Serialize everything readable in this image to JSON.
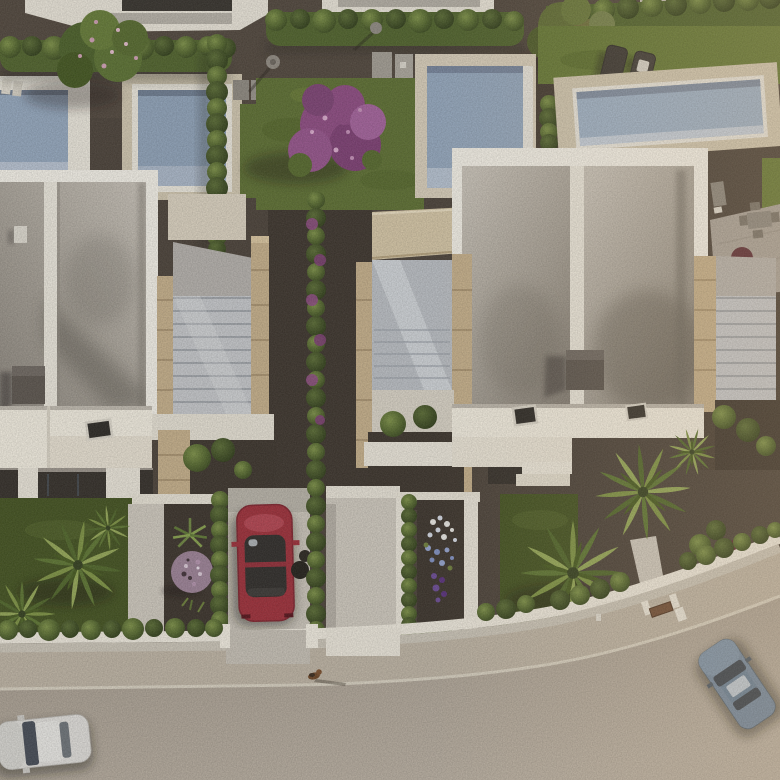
{
  "scene": {
    "type": "aerial-3d-architectural-render",
    "description": "Bird's-eye view of a modern white-villa residential development at golden hour: two large flat-roofed villas with rooftop terraces and external stone-clad stairwells, four swimming pools, hedged gardens with bougainvillea, palm trees, a red car parked in a driveway, a small dog on the sidewalk, and a curving street with a white car and a blue car.",
    "objects": {
      "villas": 2,
      "swimming_pools": 4,
      "palm_trees": 7,
      "sun_loungers": 2,
      "flowering_trees": 2,
      "dog": 1,
      "cars": [
        {
          "color_name": "red",
          "location": "driveway between hedges"
        },
        {
          "color_name": "white",
          "location": "street, bottom-left"
        },
        {
          "color_name": "blue",
          "location": "street, bottom-right curve"
        }
      ]
    }
  },
  "palette": {
    "gravel": "#4a4138",
    "gravel_dark": "#3c342c",
    "lawn": "#5c6e31",
    "lawn_bright": "#647733",
    "lawn_dark": "#42511f",
    "hedge": "#4f622b",
    "water": "#93a6bc",
    "water_light": "#9db0c5",
    "deck_white": "#e9e5da",
    "deck_beige": "#cfc5ae",
    "parapet": "#f2efe6",
    "stone": "#c4ae89",
    "chimney": "#5b544d",
    "terrace_white": "#f0ebde",
    "facade_shade": "#9a938a",
    "opening": "#332e28",
    "soil": "#3b332b",
    "path_light": "#cdc7bc",
    "wall_white": "#e8e3d7",
    "sidewalk": "#bcb2a2",
    "road": "#a69c8f",
    "road_light": "#b6ac9e",
    "curb": "#d8d1c2",
    "driveway": "#c9c3b8",
    "red_car": "#9c2e38",
    "blue_car": "#74889e",
    "white_car": "#dedcd8",
    "purple": "#8c4a80",
    "purple_ball": "#9b8195",
    "glass_stair": "#b9bdc2",
    "flower_purple": "#6b4b94",
    "canopy_sand": "#d3c4a4"
  }
}
